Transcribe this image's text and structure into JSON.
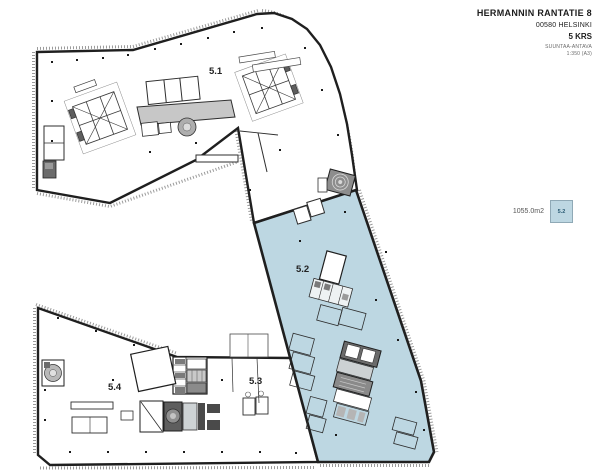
{
  "title_block": {
    "line1": "HERMANNIN RANTATIE 8",
    "line2": "00580 HELSINKI",
    "line3": "5 KRS",
    "line4": "SUUNTAA-ANTAVA",
    "line5": "1:350 (A3)"
  },
  "legend": {
    "area_label": "1055.0m2",
    "unit_label": "5.2"
  },
  "floor_plan": {
    "highlighted_section": "5.2",
    "section_labels": [
      {
        "id": "5.1"
      },
      {
        "id": "5.2"
      },
      {
        "id": "5.3"
      },
      {
        "id": "5.4"
      }
    ],
    "colors": {
      "highlight": "#bdd7e2",
      "outline": "#1f1f1f",
      "core_gray": "#c7c7c7",
      "dark_gray": "#6b6b6b"
    }
  }
}
